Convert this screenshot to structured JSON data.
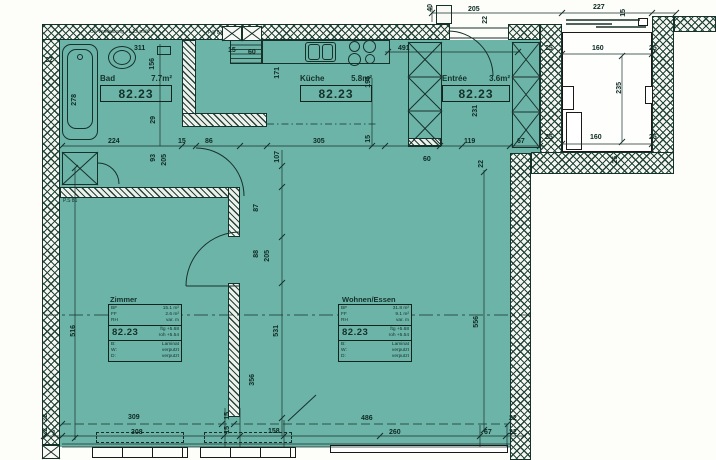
{
  "rooms": {
    "bad": {
      "name": "Bad",
      "area": "7.7m²",
      "unit": "82.23"
    },
    "kueche": {
      "name": "Küche",
      "area": "5.8m²",
      "unit": "82.23"
    },
    "entree": {
      "name": "Entrée",
      "area": "3.6m²",
      "unit": "82.23"
    },
    "zimmer": {
      "name": "Zimmer",
      "unit": "82.23",
      "info": {
        "bf_label": "BF",
        "bf_value": "15.1 m²",
        "ff_label": "FF",
        "ff_value": "2.6 m²",
        "rh_label": "RH",
        "rh_value": "var. m",
        "ftg": "ftg +5.68",
        "roh": "roh +5.54",
        "floor_label": "B:",
        "floor": "Laminat",
        "wall_label": "W:",
        "wall": "verputzt",
        "ceiling_label": "D:",
        "ceiling": "verputzt"
      }
    },
    "wohnen": {
      "name": "Wohnen/Essen",
      "unit": "82.23",
      "info": {
        "bf_label": "BF",
        "bf_value": "31.8 m²",
        "ff_label": "FF",
        "ff_value": "9.1 m²",
        "rh_label": "RH",
        "rh_value": "var. m",
        "ftg": "ftg +5.68",
        "roh": "roh +5.54",
        "floor_label": "B:",
        "floor": "Laminat",
        "wall_label": "W:",
        "wall": "verputzt",
        "ceiling_label": "D:",
        "ceiling": "verputzt"
      }
    }
  },
  "notes": {
    "top_left": "Ok Verkleidung +1.12 müK",
    "ps_top": "P.S 81",
    "ps_left": "P.S 81"
  },
  "colors": {
    "interior": "#6db4a8",
    "line": "#16302a"
  },
  "dimensions": [
    {
      "t": "40",
      "x": 427,
      "y": 4,
      "v": 1
    },
    {
      "t": "205",
      "x": 468,
      "y": 6
    },
    {
      "t": "22",
      "x": 482,
      "y": 16,
      "v": 1
    },
    {
      "t": "227",
      "x": 593,
      "y": 4
    },
    {
      "t": "15",
      "x": 620,
      "y": 9,
      "v": 1
    },
    {
      "t": "160",
      "x": 592,
      "y": 45
    },
    {
      "t": "25",
      "x": 545,
      "y": 45
    },
    {
      "t": "25",
      "x": 649,
      "y": 45
    },
    {
      "t": "235",
      "x": 616,
      "y": 82,
      "v": 1
    },
    {
      "t": "160",
      "x": 590,
      "y": 134
    },
    {
      "t": "25",
      "x": 545,
      "y": 134
    },
    {
      "t": "25",
      "x": 649,
      "y": 134
    },
    {
      "t": "25",
      "x": 612,
      "y": 156,
      "v": 1
    },
    {
      "t": "22",
      "x": 45,
      "y": 57
    },
    {
      "t": "278",
      "x": 71,
      "y": 94,
      "v": 1
    },
    {
      "t": "311",
      "x": 134,
      "y": 45
    },
    {
      "t": "156",
      "x": 149,
      "y": 58,
      "v": 1
    },
    {
      "t": "29",
      "x": 150,
      "y": 116,
      "v": 1
    },
    {
      "t": "224",
      "x": 108,
      "y": 138
    },
    {
      "t": "15",
      "x": 178,
      "y": 138
    },
    {
      "t": "86",
      "x": 205,
      "y": 138
    },
    {
      "t": "93",
      "x": 150,
      "y": 154,
      "v": 1
    },
    {
      "t": "205",
      "x": 161,
      "y": 154,
      "v": 1
    },
    {
      "t": "171",
      "x": 274,
      "y": 67,
      "v": 1
    },
    {
      "t": "15",
      "x": 228,
      "y": 47
    },
    {
      "t": "60",
      "x": 248,
      "y": 49
    },
    {
      "t": "491",
      "x": 398,
      "y": 45
    },
    {
      "t": "195",
      "x": 365,
      "y": 76,
      "v": 1
    },
    {
      "t": "305",
      "x": 313,
      "y": 138
    },
    {
      "t": "15",
      "x": 365,
      "y": 135,
      "v": 1
    },
    {
      "t": "107",
      "x": 274,
      "y": 151,
      "v": 1
    },
    {
      "t": "60",
      "x": 423,
      "y": 156
    },
    {
      "t": "231",
      "x": 472,
      "y": 105,
      "v": 1
    },
    {
      "t": "119",
      "x": 464,
      "y": 138
    },
    {
      "t": "67",
      "x": 517,
      "y": 138
    },
    {
      "t": "22",
      "x": 478,
      "y": 160,
      "v": 1
    },
    {
      "t": "87",
      "x": 253,
      "y": 204,
      "v": 1
    },
    {
      "t": "88",
      "x": 253,
      "y": 250,
      "v": 1
    },
    {
      "t": "205",
      "x": 264,
      "y": 250,
      "v": 1
    },
    {
      "t": "531",
      "x": 273,
      "y": 325,
      "v": 1
    },
    {
      "t": "356",
      "x": 249,
      "y": 374,
      "v": 1
    },
    {
      "t": "516",
      "x": 70,
      "y": 325,
      "v": 1
    },
    {
      "t": "556",
      "x": 473,
      "y": 316,
      "v": 1
    },
    {
      "t": "309",
      "x": 128,
      "y": 414
    },
    {
      "t": "15",
      "x": 224,
      "y": 412,
      "v": 1
    },
    {
      "t": "486",
      "x": 361,
      "y": 415
    },
    {
      "t": "22",
      "x": 509,
      "y": 415
    },
    {
      "t": "22",
      "x": 42,
      "y": 414,
      "v": 1
    },
    {
      "t": "22",
      "x": 42,
      "y": 428,
      "v": 1
    },
    {
      "t": "1",
      "x": 52,
      "y": 430
    },
    {
      "t": "308",
      "x": 131,
      "y": 429
    },
    {
      "t": "15",
      "x": 224,
      "y": 426,
      "v": 1
    },
    {
      "t": "158",
      "x": 268,
      "y": 428
    },
    {
      "t": "260",
      "x": 389,
      "y": 429
    },
    {
      "t": "67",
      "x": 484,
      "y": 429
    },
    {
      "t": "22",
      "x": 509,
      "y": 429
    }
  ]
}
